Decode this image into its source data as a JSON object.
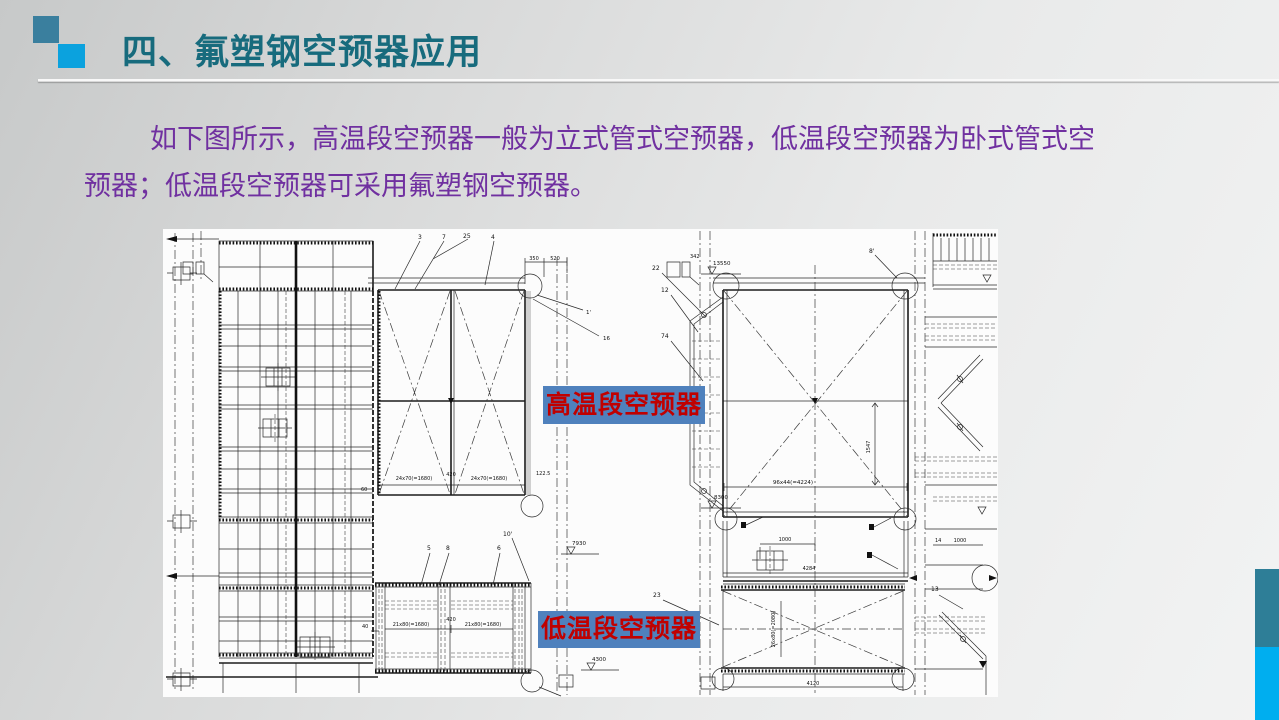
{
  "slide": {
    "title": "四、氟塑钢空预器应用",
    "body": {
      "line1": "如下图所示，高温段空预器一般为立式管式空预器，低温段空预器为卧式管式空",
      "line2": "预器；低温段空预器可采用氟塑钢空预器。"
    },
    "colors": {
      "title": "#176b7d",
      "body_text": "#7030a0",
      "accent_teal": "#3a7f9e",
      "accent_blue": "#0ba2de",
      "edge_teal": "#2e7e97",
      "edge_blue": "#00aeef",
      "callout_bg": "#4f81bd",
      "callout_text": "#c00000"
    }
  },
  "drawing": {
    "callouts": {
      "high_temp": "高温段空预器",
      "low_temp": "低温段空预器"
    },
    "dims": {
      "n3": "3",
      "n7": "7",
      "n25": "25",
      "n4": "4",
      "dim350": "350",
      "dim520": "520",
      "dim342": "342",
      "elev13550": "13550",
      "elev8300": "8300",
      "elev7930": "7930",
      "elev4300": "4300",
      "nLp": "1'",
      "n16": "16",
      "t60": "60",
      "t1680a": "24x70(=1680)",
      "t420": "420",
      "t1680b": "24x70(=1680)",
      "t122": "122.5",
      "n5": "5",
      "n8": "8",
      "n6": "6",
      "n10p": "10'",
      "lt1680a": "21x80(=1680)",
      "lt420": "420",
      "lt1680b": "21x80(=1680)",
      "lt40": "40",
      "n22": "22",
      "n12": "12",
      "n74": "74",
      "n8p": "8'",
      "big4224": "96x44(=4224)",
      "v1547": "1547",
      "dim1000a": "1000",
      "dim4284": "4284",
      "v2080": "26x80(=2080)",
      "dim4120": "4120",
      "dim1000b": "1000",
      "n14": "14",
      "n13": "13",
      "n23": "23"
    }
  }
}
